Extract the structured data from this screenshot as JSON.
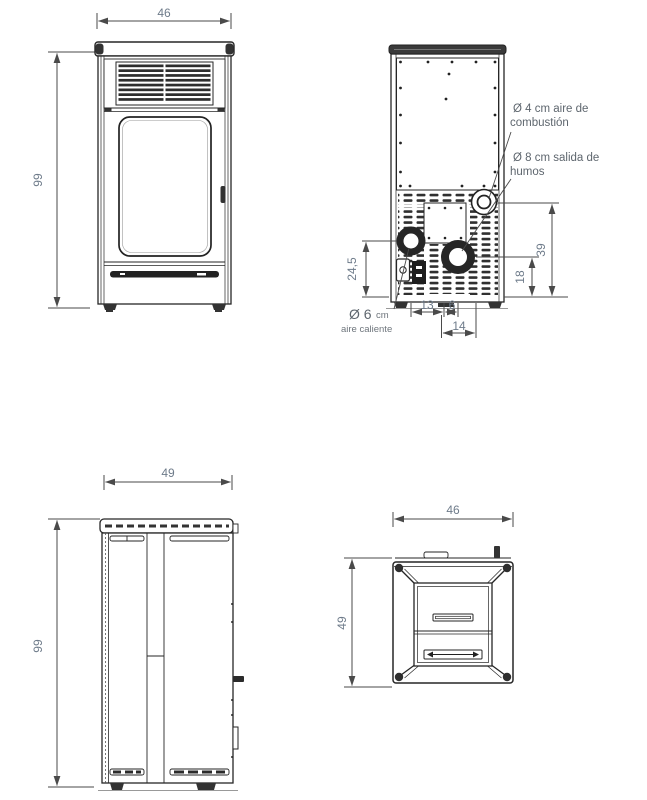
{
  "page": {
    "background": "#ffffff"
  },
  "colors": {
    "main_line": "#262626",
    "dim_line": "#4a4a4a",
    "dim_text": "#6e7b8a",
    "label_text": "#5e666e",
    "dark_fill": "#333333"
  },
  "front_view": {
    "width_dim": "46",
    "height_dim": "99"
  },
  "rear_view": {
    "combustion_label_line1": "Ø 4 cm aire de",
    "combustion_label_line2": "combustión",
    "smoke_label_line1": "Ø 8 cm salida de",
    "smoke_label_line2": "humos",
    "hot_air_diameter": "Ø 6",
    "hot_air_unit": "cm",
    "hot_air_label": "aire caliente",
    "dim_top_hole_height": "39",
    "dim_smoke_height": "18",
    "dim_hot_air_height": "24,5",
    "dim_bottom_left": "13",
    "dim_bottom_mid": "6",
    "dim_bottom_flange": "14"
  },
  "side_view": {
    "depth_dim": "49",
    "height_dim": "99"
  },
  "top_view": {
    "width_dim": "46",
    "depth_dim": "49"
  }
}
